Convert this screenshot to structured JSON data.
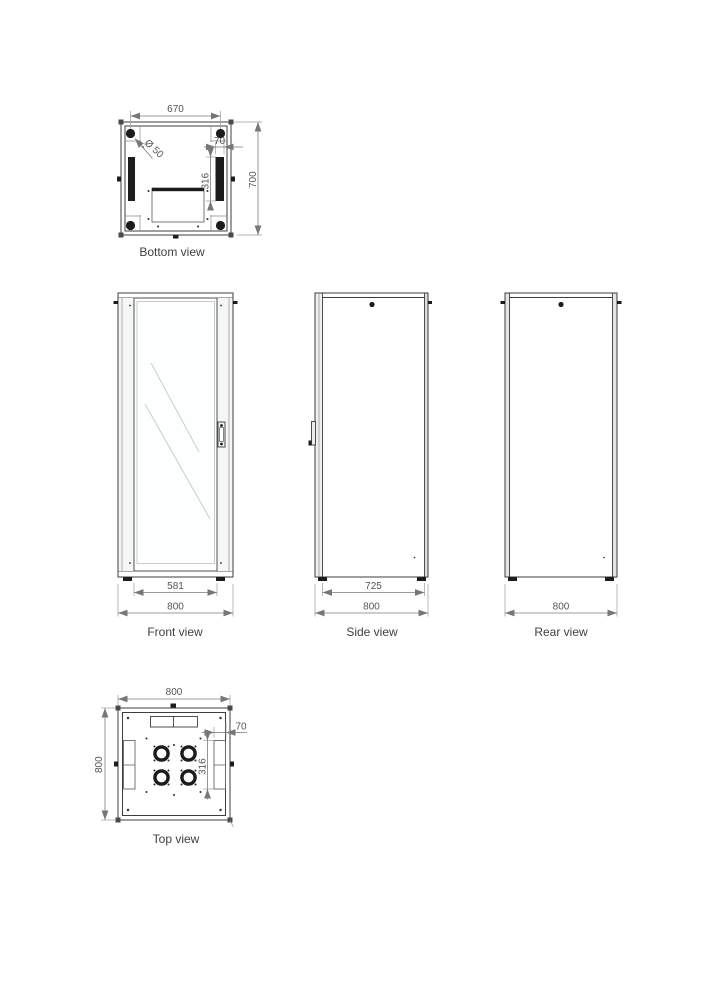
{
  "title": "Network cabinet technical drawing, five orthographic views",
  "views": {
    "bottom": {
      "label": "Bottom view",
      "dim_width_top": "670",
      "dim_hole_diameter": "Ø 50",
      "dim_slot_width": "70",
      "dim_slot_height": "316",
      "dim_depth": "700"
    },
    "front": {
      "label": "Front view",
      "dim_door_width": "581",
      "dim_width": "800"
    },
    "side": {
      "label": "Side view",
      "dim_body_depth": "725",
      "dim_depth": "800"
    },
    "rear": {
      "label": "Rear view",
      "dim_width": "800"
    },
    "top": {
      "label": "Top view",
      "dim_width": "800",
      "dim_depth": "800",
      "dim_slot_width": "70",
      "dim_slot_height": "316"
    }
  },
  "colors": {
    "line": "#3d3d3d",
    "dim_line": "#7a7a7a",
    "dim_text": "#555555",
    "label_text": "#3f3f3f",
    "fill_dark": "#1c1c1c",
    "glass_line": "#c9cdd0"
  }
}
